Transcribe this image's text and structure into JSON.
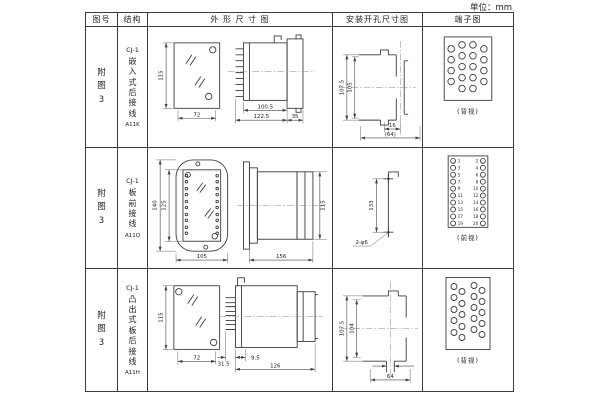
{
  "unit_label": "单位：mm",
  "table": {
    "headers": {
      "fig_no": "图号",
      "structure": "结构",
      "outline": "外 形 尺 寸 图",
      "mounting": "安装开孔尺寸图",
      "terminal": "端子图"
    },
    "rows": [
      {
        "fig_no": "附图3",
        "structure_prefix": "CJ-1",
        "structure_chars": "嵌入式后接线",
        "model": "A11K",
        "outline_dims": {
          "front_height": "115",
          "front_width": "72",
          "body_depth": "100.5",
          "total_depth": "122.5",
          "flange_depth": "35"
        },
        "mounting_dims": {
          "outer_height": "107.5",
          "inner_height": "105",
          "slot_width": "16",
          "width": "(64)"
        },
        "terminal_view": "(背视)"
      },
      {
        "fig_no": "附图3",
        "structure_prefix": "CJ-1",
        "structure_chars": "板前接线",
        "model": "A11Q",
        "outline_dims": {
          "outer_height": "140",
          "inner_height": "125",
          "front_width": "105",
          "body_depth": "156",
          "side_height": "115"
        },
        "mounting_dims": {
          "hole_spacing": "133",
          "hole_label": "2-φ6"
        },
        "terminal_numbers": {
          "left": [
            "1",
            "3",
            "5",
            "7",
            "9",
            "11",
            "13",
            "15",
            "17",
            "19"
          ],
          "right": [
            "2",
            "4",
            "6",
            "8",
            "10",
            "12",
            "14",
            "16",
            "18",
            "20"
          ]
        },
        "terminal_view": "(前视)"
      },
      {
        "fig_no": "附图3",
        "structure_prefix": "CJ-1",
        "structure_chars": "凸出式板后接线",
        "model": "A11H",
        "outline_dims": {
          "front_height": "115",
          "front_width": "72",
          "pin_depth": "31.5",
          "gap": "9.5",
          "body_depth": "126"
        },
        "mounting_dims": {
          "outer_height": "107.5",
          "inner_height": "104",
          "width": "64"
        },
        "terminal_view": "(背视)"
      }
    ]
  }
}
